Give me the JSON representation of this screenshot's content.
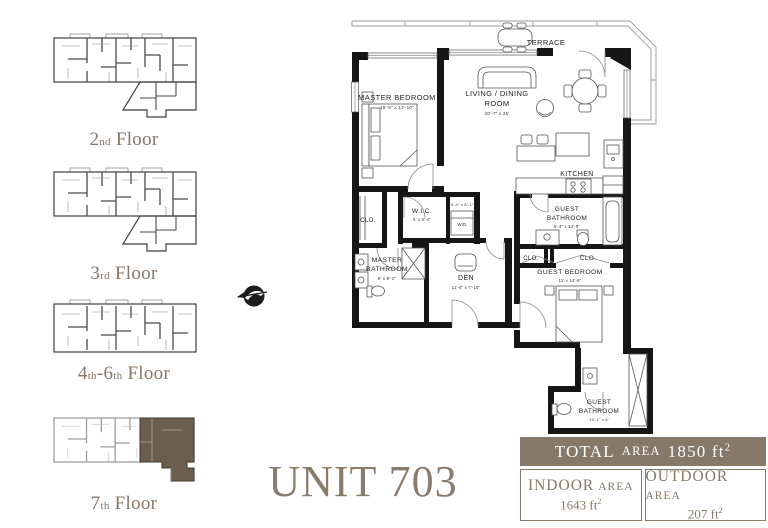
{
  "title": {
    "unit": "UNIT 703"
  },
  "sidebar": {
    "floors": [
      {
        "num": "2",
        "ord": "nd",
        "mid": "",
        "ord2": "",
        "rest": "Floor"
      },
      {
        "num": "3",
        "ord": "rd",
        "mid": "",
        "ord2": "",
        "rest": "Floor"
      },
      {
        "num": "4",
        "ord": "th",
        "mid": "-6",
        "ord2": "th",
        "rest": "Floor"
      },
      {
        "num": "7",
        "ord": "th",
        "mid": "",
        "ord2": "",
        "rest": "Floor"
      }
    ]
  },
  "icons": {
    "compass": "compass-north-arrow"
  },
  "plan": {
    "terrace": {
      "label": "TERRACE"
    },
    "master_bedroom": {
      "label": "MASTER BEDROOM",
      "dims": "16'-5\" x 12'-10\""
    },
    "living_dining": {
      "label_line1": "LIVING / DINING",
      "label_line2": "ROOM",
      "dims": "20'-7\" x 25'"
    },
    "kitchen": {
      "label": "KITCHEN"
    },
    "master_closet": {
      "label": "CLO."
    },
    "wic": {
      "label": "W.I.C.",
      "dims": "6' x 6'-4\""
    },
    "laundry": {
      "dims": "4'-4\" x 6'-1\"",
      "appliance": "W/D"
    },
    "master_bathroom": {
      "label_line1": "MASTER",
      "label_line2": "BATHROOM",
      "dims": "8' x 9'-2\""
    },
    "den": {
      "label": "DEN",
      "dims": "11'-6\" x 7'-10\""
    },
    "guest_bathroom_upper": {
      "label_line1": "GUEST",
      "label_line2": "BATHROOM",
      "dims": "5'-4\" x 14'-8\""
    },
    "closet_left": {
      "label": "CLO."
    },
    "closet_right": {
      "label": "CLO."
    },
    "guest_bedroom": {
      "label": "GUEST BEDROOM",
      "dims": "11' x 14'-8\""
    },
    "guest_bathroom_lower": {
      "label_line1": "GUEST",
      "label_line2": "BATHROOM",
      "dims": "15'-1\" x 6'"
    }
  },
  "area_table": {
    "total": {
      "name": "TOTAL",
      "area_word": "AREA",
      "value": "1850 ft",
      "sup": "2"
    },
    "indoor": {
      "name": "INDOOR",
      "area_word": "AREA",
      "value": "1643 ft",
      "sup": "2"
    },
    "outdoor": {
      "name": "OUTDOOR",
      "area_word": "AREA",
      "value": "207 ft",
      "sup": "2"
    }
  },
  "colors": {
    "accent_brown": "#86796a",
    "highlight_unit": "#6b5e4f",
    "plan_line": "#161616"
  }
}
